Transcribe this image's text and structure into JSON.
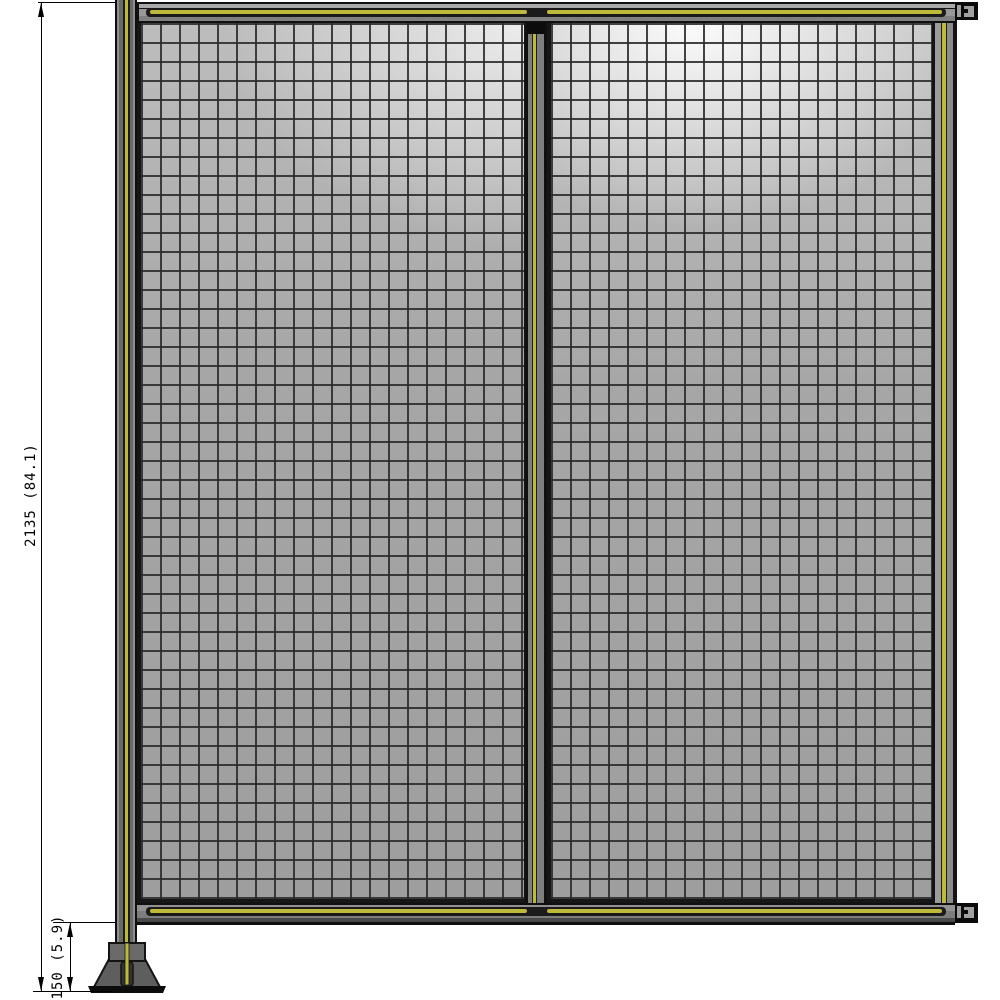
{
  "drawing": {
    "type": "technical-product-drawing",
    "subject": "wire-mesh safety fence unit, front elevation, two panels with upright post and floor bracket",
    "dimensions": {
      "overall_height": {
        "label": "2135 (84.1)"
      },
      "base_height": {
        "label": "150 (5.9)"
      }
    },
    "colors": {
      "background": "#ffffff",
      "accent_stripe_yellow": "#bdb93a",
      "frame_gray": "#8a8a8a",
      "mesh_fill_gray": "#a6a6a6",
      "mesh_wire": "#2a2a2a",
      "outline_black": "#141414"
    },
    "components": {
      "left_mesh_panel": "wire mesh panel",
      "right_mesh_panel": "wire mesh panel",
      "top_rail": "horizontal top rail",
      "bottom_rail": "horizontal bottom rail",
      "upright_post": "left vertical post",
      "center_post": "center vertical frame member",
      "right_end_frame": "right vertical end frame",
      "wall_bracket_top": "right upper mounting bracket",
      "wall_bracket_bottom": "right lower mounting bracket",
      "base_foot": "floor base foot"
    }
  }
}
